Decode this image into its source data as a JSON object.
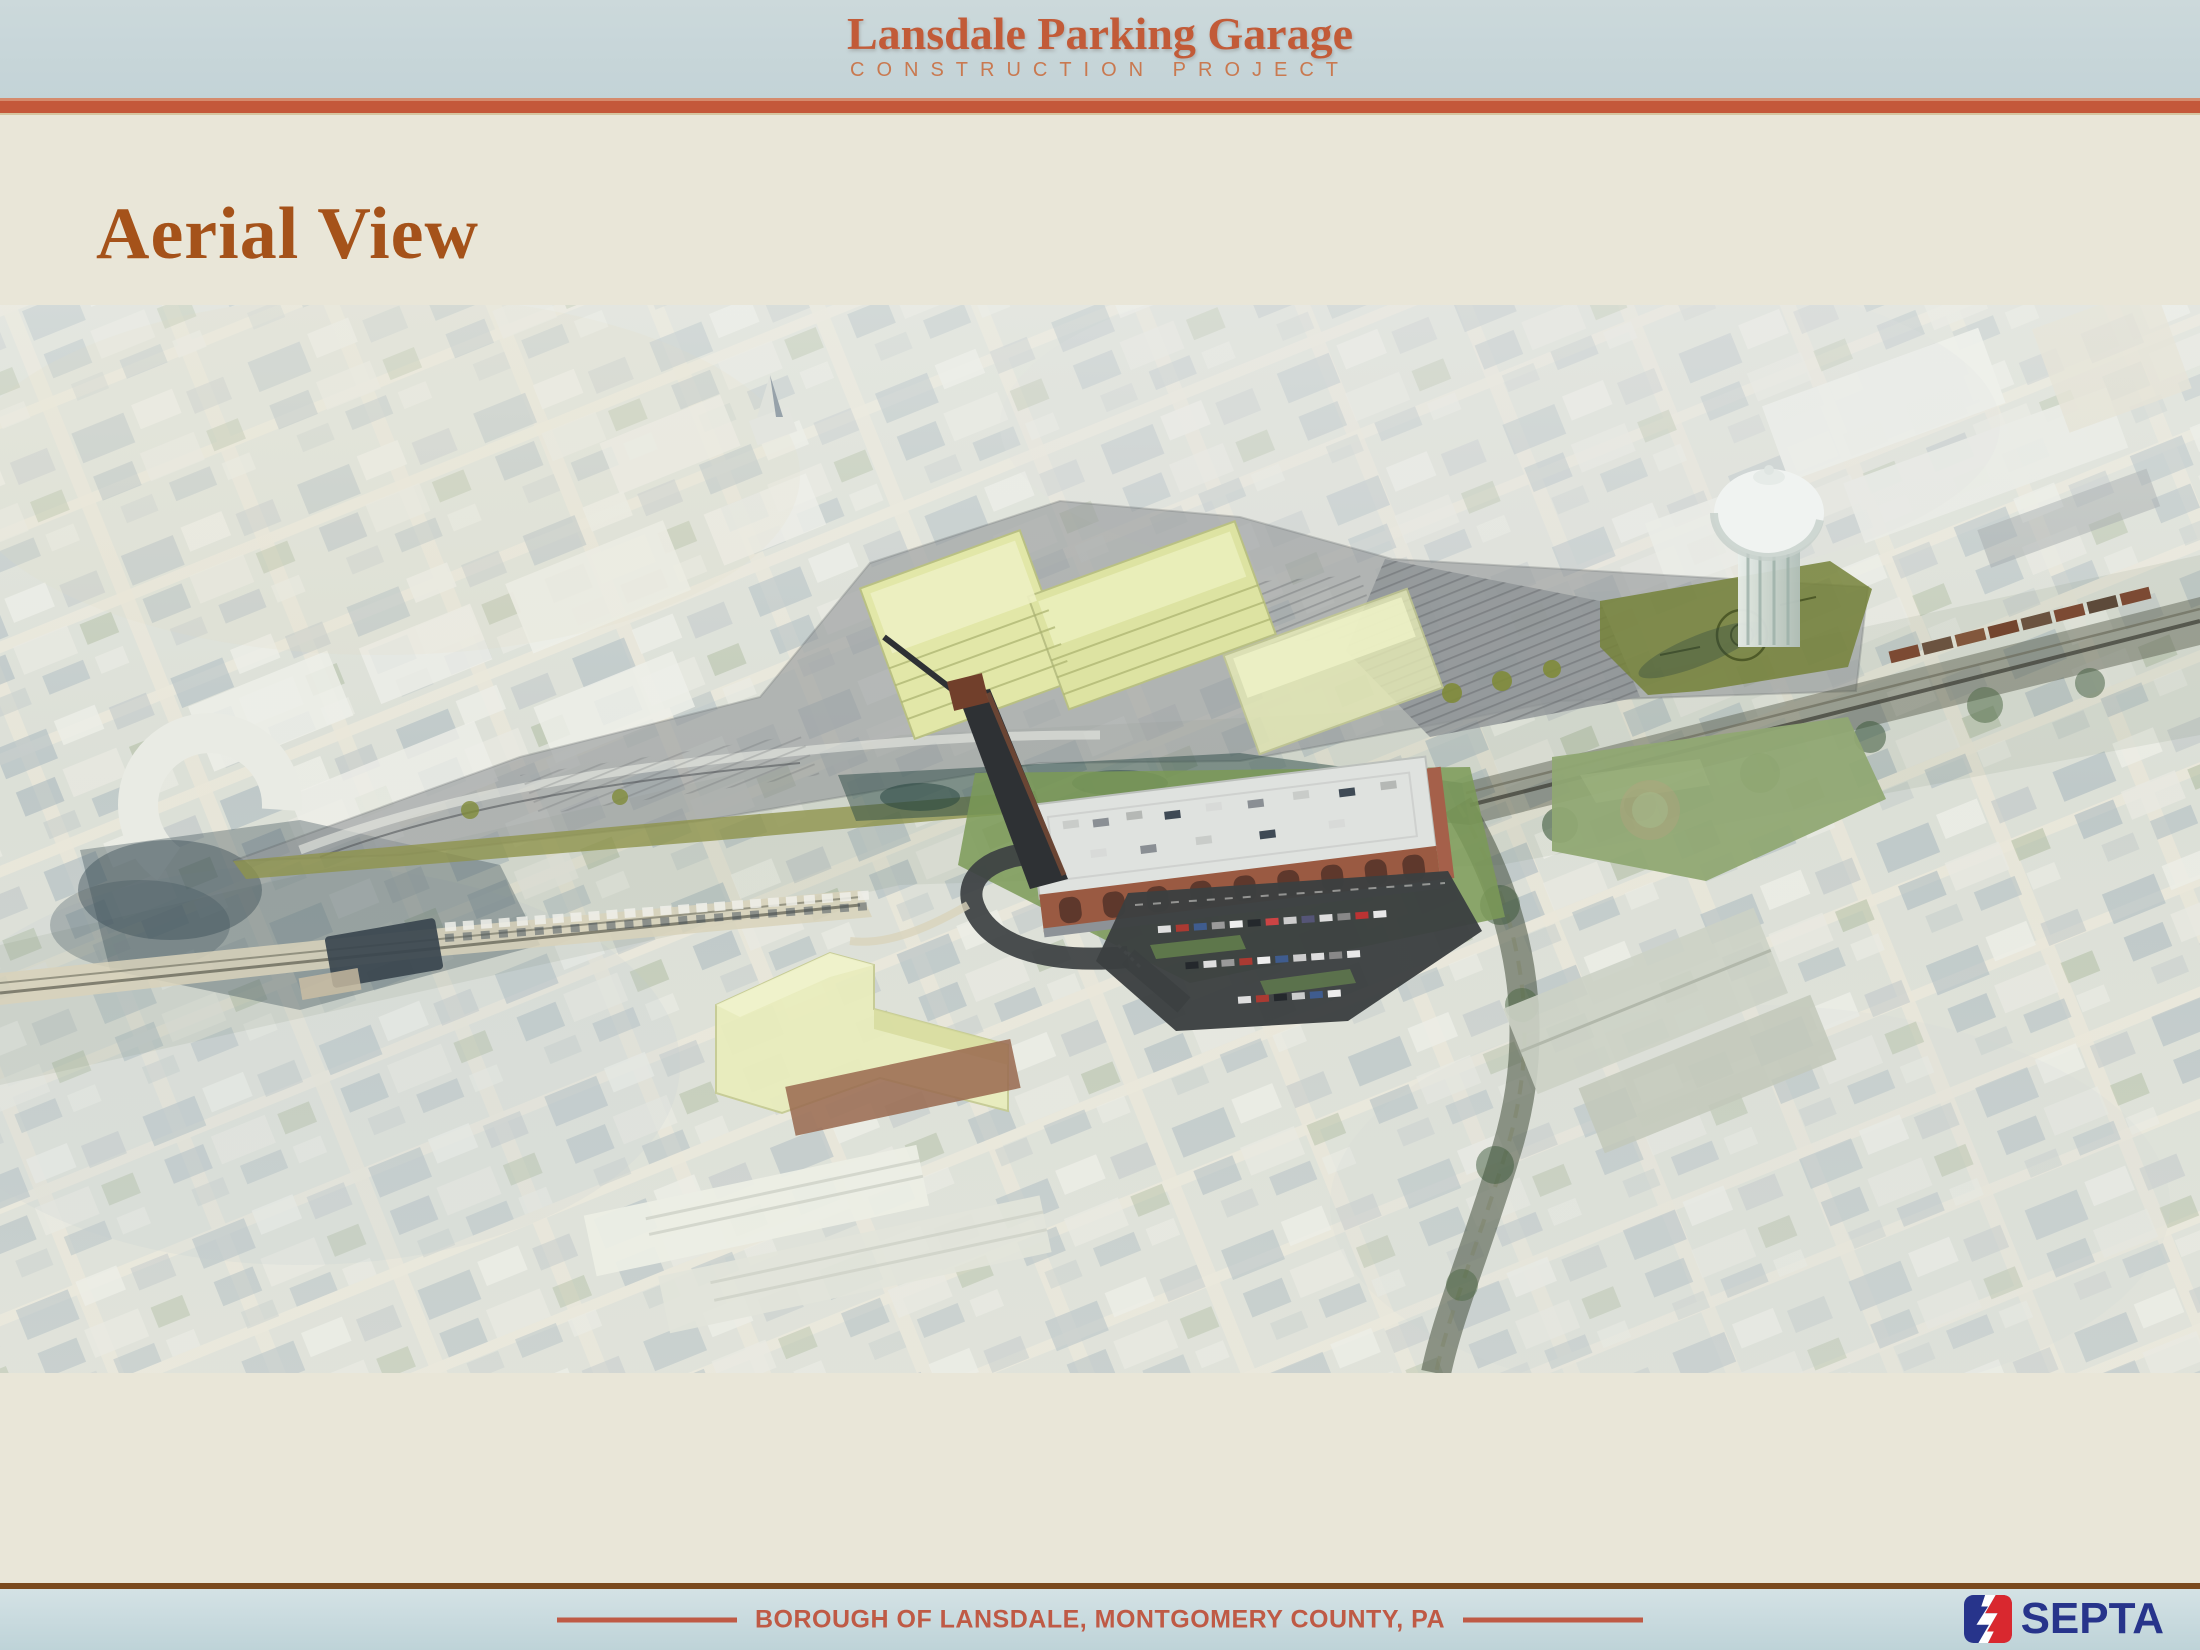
{
  "header": {
    "title": "Lansdale Parking Garage",
    "subtitle": "CONSTRUCTION PROJECT"
  },
  "slide": {
    "title": "Aerial View"
  },
  "footer": {
    "location": "BOROUGH OF LANSDALE, MONTGOMERY COUNTY, PA",
    "brand": "SEPTA"
  },
  "colors": {
    "page_background": "#e9e6d8",
    "header_band": "#c6d6d9",
    "accent_orange_rule": "#c4583a",
    "header_title_orange": "#c25b38",
    "slide_title_brown": "#a5521a",
    "footer_divider_brown": "#7a4a1e",
    "footer_band_blue": "#c9dbdf",
    "footer_text_orange": "#bf5a45",
    "septa_navy": "#27348b",
    "septa_red": "#d9282f",
    "massing_yellow": "#e7ecb6",
    "garage_brick": "#9a5a42",
    "site_plan_gray": "#95999b",
    "site_plan_olive": "#76823a"
  }
}
